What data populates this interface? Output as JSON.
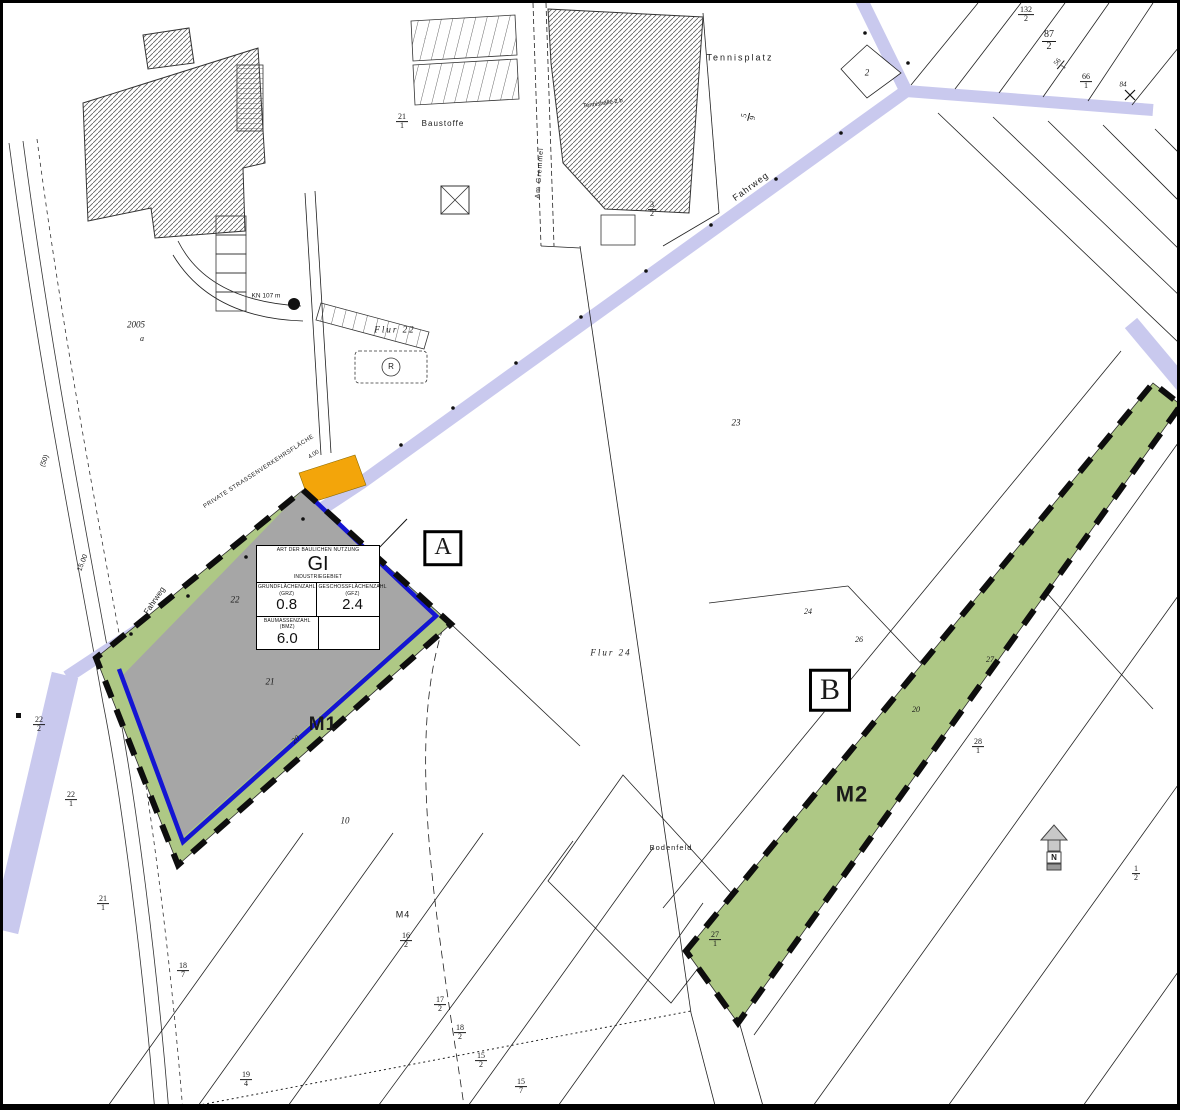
{
  "colors": {
    "road_band": "#c9c9ee",
    "green_zone": "#aec885",
    "gray_zone": "#a6a6a6",
    "baugrenze_blue": "#1515d2",
    "access_orange": "#f3a50a",
    "line_black": "#1a1a1a"
  },
  "zoning_table": {
    "use_type_header": "ART DER BAULICHEN NUTZUNG",
    "use_code": "GI",
    "use_subtitle": "INDUSTRIEGEBIET",
    "cells": [
      {
        "label": "GRUNDFLÄCHENZAHL (GRZ)",
        "value": "0.8"
      },
      {
        "label": "GESCHOSSFLÄCHENZAHL (GFZ)",
        "value": "2.4"
      },
      {
        "label": "BAUMASSENZAHL (BMZ)",
        "value": "6.0"
      },
      {
        "label": "",
        "value": ""
      }
    ]
  },
  "north_arrow": {
    "letter": "N"
  },
  "labels": [
    {
      "n": "label-tennisplatz",
      "t": "Tennisplatz",
      "x": 737,
      "y": 55,
      "s": 9,
      "sp": 2
    },
    {
      "n": "label-fahrweg",
      "t": "Fahrweg",
      "x": 748,
      "y": 184,
      "r": -36,
      "s": 9,
      "sp": 1
    },
    {
      "n": "label-fahrweg-west",
      "t": "Fahrweg",
      "x": 152,
      "y": 598,
      "r": -56,
      "s": 8
    },
    {
      "n": "label-baustoffe",
      "t": "Baustoffe",
      "x": 440,
      "y": 121,
      "s": 8,
      "sp": 1
    },
    {
      "n": "parcel-21-1-top",
      "fr": [
        "21",
        "1"
      ],
      "x": 399,
      "y": 119,
      "s": 8,
      "f": "serif"
    },
    {
      "n": "label-tennishalle",
      "t": "Tennishalle 2 b",
      "x": 600,
      "y": 101,
      "r": -8,
      "s": 6
    },
    {
      "n": "label-am-gremmel",
      "t": "Am Gremmel",
      "x": 537,
      "y": 170,
      "r": -86,
      "s": 7,
      "sp": 1
    },
    {
      "n": "parcel-3-2",
      "fr": [
        "3",
        "2"
      ],
      "x": 649,
      "y": 207,
      "s": 8,
      "f": "serif"
    },
    {
      "n": "parcel-5-9",
      "fr": [
        "5",
        "9"
      ],
      "x": 746,
      "y": 114,
      "r": -75,
      "s": 8,
      "f": "serif"
    },
    {
      "n": "parcel-2-diamond",
      "t": "2",
      "x": 864,
      "y": 70,
      "s": 9,
      "i": 1,
      "f": "serif"
    },
    {
      "n": "parcel-132-2",
      "fr": [
        "132",
        "2"
      ],
      "x": 1023,
      "y": 12,
      "s": 8,
      "f": "serif"
    },
    {
      "n": "parcel-87-2",
      "fr": [
        "87",
        "2"
      ],
      "x": 1046,
      "y": 38,
      "s": 10,
      "f": "serif"
    },
    {
      "n": "parcel-56-1",
      "fr": [
        "56",
        "1"
      ],
      "x": 1058,
      "y": 62,
      "r": -50,
      "s": 7,
      "f": "serif"
    },
    {
      "n": "parcel-66-1",
      "fr": [
        "66",
        "1"
      ],
      "x": 1083,
      "y": 79,
      "s": 8,
      "f": "serif"
    },
    {
      "n": "parcel-84",
      "t": "84",
      "x": 1120,
      "y": 82,
      "s": 7,
      "i": 1,
      "f": "serif"
    },
    {
      "n": "label-flur-22",
      "t": "Flur 22",
      "x": 392,
      "y": 327,
      "s": 9,
      "i": 1,
      "f": "serif",
      "sp": 2
    },
    {
      "n": "parcel-2005a",
      "t": "2005",
      "x": 133,
      "y": 322,
      "s": 9,
      "i": 1,
      "f": "serif"
    },
    {
      "n": "parcel-2005a-sub",
      "t": "a",
      "x": 139,
      "y": 336,
      "s": 8,
      "i": 1,
      "f": "serif"
    },
    {
      "n": "label-kn-point",
      "t": "KN 107 m",
      "x": 263,
      "y": 294,
      "s": 6.5
    },
    {
      "n": "r-marker-label",
      "t": "R",
      "x": 388,
      "y": 364,
      "s": 8
    },
    {
      "n": "dim-50",
      "t": "(50)",
      "x": 42,
      "y": 458,
      "r": -68,
      "s": 7
    },
    {
      "n": "dim-15-00",
      "t": "15.00",
      "x": 80,
      "y": 560,
      "r": -68,
      "s": 7
    },
    {
      "n": "label-private-strasse",
      "t": "PRIVATE STRASSENVERKEHRSFLÄCHE",
      "x": 256,
      "y": 469,
      "r": -33,
      "s": 6,
      "sp": 0.5
    },
    {
      "n": "dim-4-00",
      "t": "4.00",
      "x": 311,
      "y": 452,
      "r": -33,
      "s": 6
    },
    {
      "n": "parcel-23",
      "t": "23",
      "x": 733,
      "y": 420,
      "s": 9,
      "i": 1,
      "f": "serif"
    },
    {
      "n": "label-flur-24",
      "t": "Flur 24",
      "x": 608,
      "y": 650,
      "s": 9,
      "i": 1,
      "f": "serif",
      "sp": 2
    },
    {
      "n": "parcel-22",
      "t": "22",
      "x": 232,
      "y": 597,
      "s": 9,
      "i": 1,
      "f": "serif"
    },
    {
      "n": "parcel-21",
      "t": "21",
      "x": 267,
      "y": 679,
      "s": 9,
      "i": 1,
      "f": "serif"
    },
    {
      "n": "parcel-20-m1",
      "t": "20",
      "x": 293,
      "y": 737,
      "r": -42,
      "s": 8,
      "i": 1,
      "f": "serif"
    },
    {
      "n": "parcel-10",
      "t": "10",
      "x": 342,
      "y": 818,
      "s": 9,
      "i": 1,
      "f": "serif"
    },
    {
      "n": "zone-label-m1",
      "t": "M1",
      "x": 320,
      "y": 722,
      "s": 19,
      "b": 1,
      "sp": 1
    },
    {
      "n": "section-marker-a",
      "t": "A",
      "x": 440,
      "y": 545,
      "s": 24,
      "cls": "boxed"
    },
    {
      "n": "section-marker-b",
      "t": "B",
      "x": 827,
      "y": 687,
      "s": 30,
      "cls": "boxed"
    },
    {
      "n": "zone-label-m2",
      "t": "M2",
      "x": 849,
      "y": 791,
      "s": 22,
      "b": 1,
      "sp": 1
    },
    {
      "n": "label-bodenfeld",
      "t": "Bodenfeld",
      "x": 668,
      "y": 845,
      "s": 7.5,
      "sp": 1
    },
    {
      "n": "parcel-24",
      "t": "24",
      "x": 805,
      "y": 609,
      "s": 8,
      "i": 1,
      "f": "serif"
    },
    {
      "n": "parcel-26",
      "t": "26",
      "x": 856,
      "y": 637,
      "s": 8,
      "i": 1,
      "f": "serif"
    },
    {
      "n": "parcel-20-m2",
      "t": "20",
      "x": 913,
      "y": 707,
      "s": 8,
      "i": 1,
      "f": "serif"
    },
    {
      "n": "parcel-27",
      "t": "27",
      "x": 987,
      "y": 657,
      "s": 8,
      "i": 1,
      "f": "serif"
    },
    {
      "n": "parcel-28-1",
      "fr": [
        "28",
        "1"
      ],
      "x": 975,
      "y": 744,
      "s": 8,
      "f": "serif"
    },
    {
      "n": "parcel-27-1",
      "fr": [
        "27",
        "1"
      ],
      "x": 712,
      "y": 937,
      "s": 8,
      "f": "serif"
    },
    {
      "n": "parcel-22-2",
      "fr": [
        "22",
        "2"
      ],
      "x": 36,
      "y": 722,
      "s": 8,
      "f": "serif"
    },
    {
      "n": "parcel-22-1",
      "fr": [
        "22",
        "1"
      ],
      "x": 68,
      "y": 797,
      "s": 8,
      "f": "serif"
    },
    {
      "n": "parcel-21-1",
      "fr": [
        "21",
        "1"
      ],
      "x": 100,
      "y": 901,
      "s": 8,
      "f": "serif"
    },
    {
      "n": "parcel-18-7",
      "fr": [
        "18",
        "7"
      ],
      "x": 180,
      "y": 968,
      "s": 8,
      "f": "serif"
    },
    {
      "n": "zone-label-m4",
      "t": "M4",
      "x": 400,
      "y": 912,
      "s": 9,
      "sp": 1
    },
    {
      "n": "parcel-16-2",
      "fr": [
        "16",
        "2"
      ],
      "x": 403,
      "y": 938,
      "s": 8,
      "f": "serif"
    },
    {
      "n": "parcel-17-2",
      "fr": [
        "17",
        "2"
      ],
      "x": 437,
      "y": 1002,
      "s": 8,
      "f": "serif"
    },
    {
      "n": "parcel-18-2",
      "fr": [
        "18",
        "2"
      ],
      "x": 457,
      "y": 1030,
      "s": 8,
      "f": "serif"
    },
    {
      "n": "parcel-15-2",
      "fr": [
        "15",
        "2"
      ],
      "x": 478,
      "y": 1058,
      "s": 8,
      "f": "serif"
    },
    {
      "n": "parcel-15-7",
      "fr": [
        "15",
        "7"
      ],
      "x": 518,
      "y": 1084,
      "s": 8,
      "f": "serif"
    },
    {
      "n": "parcel-19-4",
      "fr": [
        "19",
        "4"
      ],
      "x": 243,
      "y": 1077,
      "s": 8,
      "f": "serif"
    },
    {
      "n": "parcel-1-2",
      "fr": [
        "1",
        "2"
      ],
      "x": 1133,
      "y": 871,
      "s": 8,
      "f": "serif"
    },
    {
      "n": "north-arrow-letter",
      "t": "N",
      "x": 1051,
      "y": 855,
      "s": 8,
      "b": 1
    }
  ]
}
